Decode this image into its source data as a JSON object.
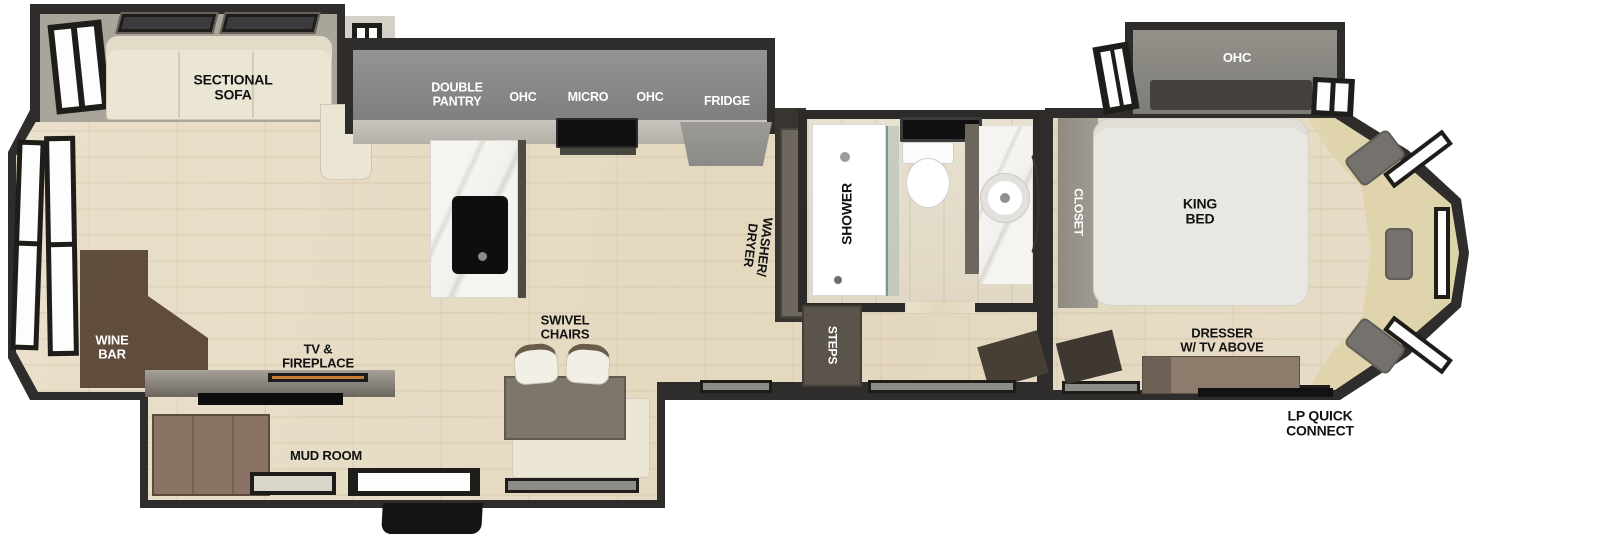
{
  "title": "RV fifth-wheel floor plan",
  "labels": {
    "sectional_sofa": "SECTIONAL\nSOFA",
    "double_pantry": "DOUBLE\nPANTRY",
    "ohc_kitchen_left": "OHC",
    "micro": "MICRO",
    "ohc_kitchen_right": "OHC",
    "fridge": "FRIDGE",
    "washer_dryer": "WASHER/\nDRYER",
    "shower": "SHOWER",
    "steps": "STEPS",
    "closet": "CLOSET",
    "ohc_bedroom": "OHC",
    "king_bed": "KING\nBED",
    "dresser": "DRESSER\nW/ TV ABOVE",
    "lp_quick_connect": "LP QUICK\nCONNECT",
    "wine_bar": "WINE\nBAR",
    "tv_fireplace": "TV &\nFIREPLACE",
    "swivel_chairs": "SWIVEL\nCHAIRS",
    "mud_room": "MUD ROOM"
  },
  "colors": {
    "wall_dark": "#2e2d2b",
    "wall_lining": "#a9a59a",
    "floor_wood": "#e6dcc6",
    "counter_gray": "#8f8e8c",
    "counter_edge": "#c4c1ba",
    "sofa_cream": "#ebe5d4",
    "bed_white": "#e9e7e1",
    "bench_tan": "#e4dab4",
    "marble": "#f4f2ee",
    "wine_bar_brown": "#5a4637",
    "dresser_brown": "#8d7b6c",
    "pillow_gray": "#75726d",
    "steps_gray": "#5a544c",
    "fireplace_accent": "#c77c33"
  }
}
